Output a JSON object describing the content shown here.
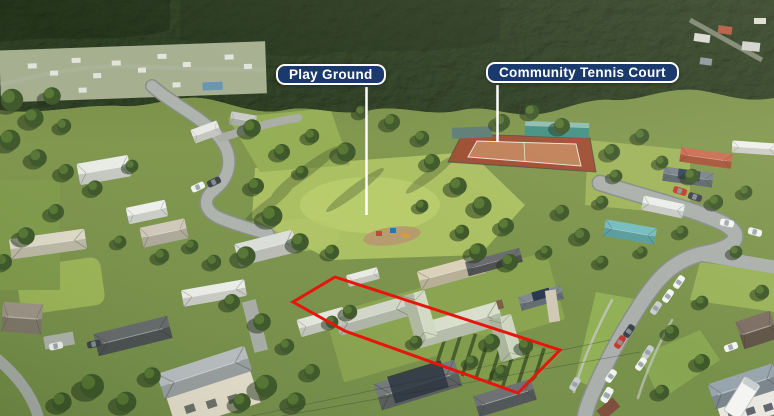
{
  "annotations": {
    "labels": [
      {
        "id": "playground",
        "text": "Play Ground"
      },
      {
        "id": "tennis-court",
        "text": "Community Tennis Court"
      }
    ]
  },
  "colors": {
    "label_background": "#1a3a6d",
    "label_border": "#ffffff",
    "label_text": "#ffffff",
    "pointer_line": "#ffffff",
    "property_boundary": "#e8150c"
  }
}
